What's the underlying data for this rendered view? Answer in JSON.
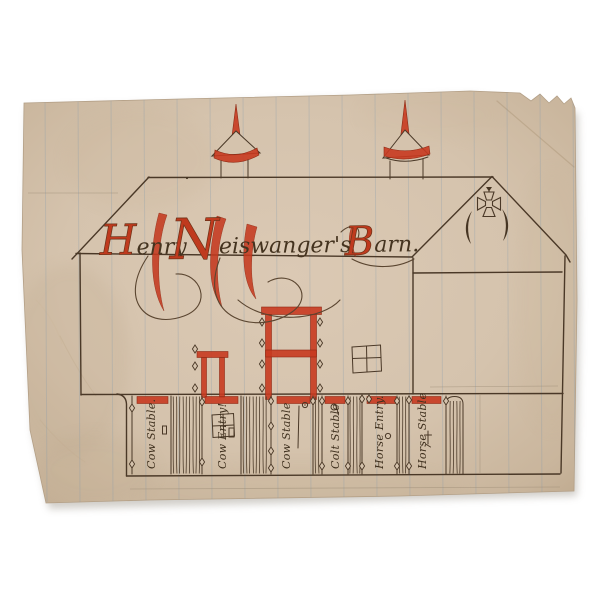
{
  "artwork": {
    "kind": "hand-drawn barn elevation, ink and red watercolor on lined paper",
    "background_color": "#ffffff",
    "paper_color": "#d5c3ad",
    "ink_color": "#4a3827",
    "red_color": "#c83a20",
    "ruled_line_color": "#7f99ad"
  },
  "title": {
    "full": "Henry Neiswanger's Barn.",
    "parts": [
      {
        "cap": "H",
        "rest": "enry"
      },
      {
        "cap": "N",
        "rest": "eiswanger's"
      },
      {
        "cap": "B",
        "rest": "arn."
      }
    ]
  },
  "stalls": [
    {
      "label": "Cow Stable."
    },
    {
      "label": "Cow Entry!"
    },
    {
      "label": "Cow Stable"
    },
    {
      "label": "Colt Stable"
    },
    {
      "label": "Horse Entry."
    },
    {
      "label": "Horse Stable"
    }
  ],
  "ornaments": {
    "gable": [
      "maltese-cross",
      "crescent-vent-left",
      "crescent-vent-right"
    ],
    "roof": [
      "cupola-with-red-spire",
      "cupola-with-red-spire"
    ],
    "facade": [
      "red-framed-hay-door",
      "red-framed-double-door",
      "four-pane-window"
    ]
  }
}
